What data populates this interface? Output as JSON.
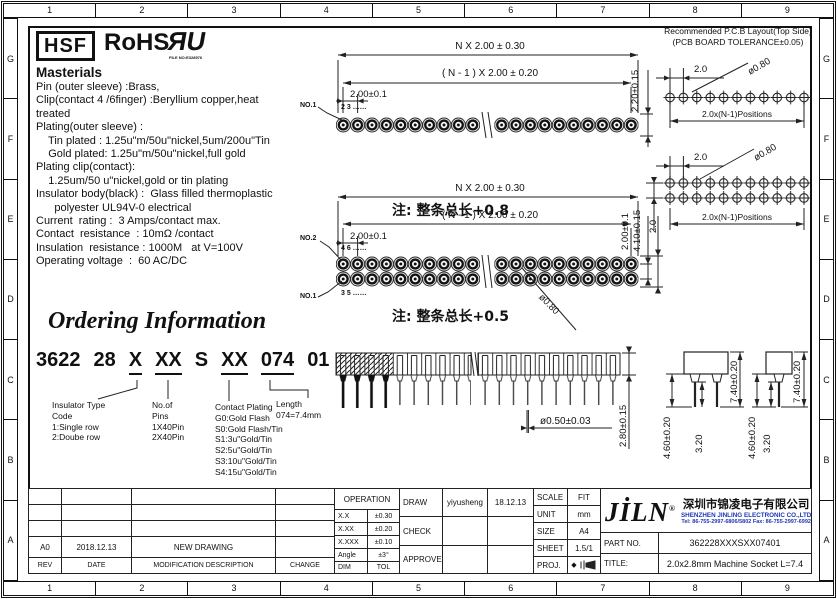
{
  "border": {
    "cols": [
      "1",
      "2",
      "3",
      "4",
      "5",
      "6",
      "7",
      "8",
      "9"
    ],
    "rows": [
      "G",
      "F",
      "E",
      "D",
      "C",
      "B",
      "A"
    ]
  },
  "header": {
    "hsf": "HSF",
    "rohs": "RoHS",
    "ul_mark": "ЯU",
    "ul_file": "FILE NO:E328976"
  },
  "materials": {
    "heading": "Masterials",
    "lines": [
      "Pin (outer sleeve) :Brass,",
      "Clip(contact 4 /6finger) :Beryllium copper,heat",
      "treated",
      "Plating(outer sleeve) :",
      "    Tin plated : 1.25u\"m/50u\"nickel,5um/200u\"Tin",
      "    Gold plated: 1.25u\"m/50u\"nickel,full gold",
      "Plating clip(contact):",
      "    1.25um/50 u\"nickel,gold or tin plating",
      "Insulator body(black) :  Glass filled thermoplastic",
      "      polyester UL94V-0 electrical",
      "Current  rating :  3 Amps/contact max.",
      "Contact  resistance  : 10mΩ /contact",
      "Insulation  resistance : 1000M   at V=100V",
      "Operating voltage  :  60 AC/DC"
    ]
  },
  "ordering": {
    "title": "Ordering Information",
    "code": [
      "3622",
      "28",
      "X",
      "XX",
      "S",
      "XX",
      "074",
      "01"
    ],
    "c1": [
      "Insulator  Type",
      "Code",
      "1:Single  row",
      "2:Doube  row"
    ],
    "c2": [
      "No.of",
      "Pins",
      "1X40Pin",
      "2X40Pin"
    ],
    "c3": [
      "Contact  Plating",
      "G0:Gold  Flash",
      "S0:Gold  Flash/Tin",
      "S1:3u\"Gold/Tin",
      "S2:5u\"Gold/Tin",
      "S3:10u\"Gold/Tin",
      "S4:15u\"Gold/Tin"
    ],
    "c4": [
      "Length",
      "074=7.4mm"
    ]
  },
  "drawing1": {
    "dim_total": "N X 2.00 ± 0.30",
    "dim_n1": "( N - 1 ) X 2.00 ± 0.20",
    "dim_pitch": "2.00±0.1",
    "dim_height": "2.20±0.15",
    "pin1": "NO.1",
    "pin_numbers": "2  3 ……",
    "note": "注: 整条总长+0.8"
  },
  "drawing2": {
    "dim_total": "N X 2.00 ± 0.30",
    "dim_n1": "( N - 1 ) X 2.00 ± 0.20",
    "dim_pitch": "2.00±0.1",
    "dim_row_pitch": "2.00±0.1",
    "dim_height": "4.10±0.15",
    "hole_dia": "ø0.80",
    "pin2": "NO.2",
    "pin2_numbers": "4  6 ……",
    "pin1": "NO.1",
    "pin1_numbers": "3  5 ……",
    "note": "注: 整条总长+0.5"
  },
  "pcb": {
    "line1": "Recommended P.C.B Layout(Top Side)",
    "line2": "(PCB BOARD TOLERANCE±0.05)",
    "pitch": "2.0",
    "hole": "ø0.80",
    "positions": "2.0x(N-1)Positions",
    "row_pitch": "2.0"
  },
  "side_view": {
    "pin_dia": "ø0.50±0.03",
    "height": "2.80±0.15"
  },
  "end_view": {
    "total": "7.40±0.20",
    "pin_len": "4.60±0.20",
    "mid": "3.20"
  },
  "titleblock": {
    "revision": {
      "row": [
        "A0",
        "2018.12.13",
        "NEW  DRAWING",
        ""
      ],
      "header": [
        "REV",
        "DATE",
        "MODIFICATION  DESCRIPTION",
        "CHANGE"
      ]
    },
    "tolerance": {
      "header": "OPERATION",
      "rows": [
        [
          "X.X",
          "±0.30"
        ],
        [
          "X.XX",
          "±0.20"
        ],
        [
          "X.XXX",
          "±0.10"
        ],
        [
          "Angle",
          "±3°"
        ],
        [
          "DIM",
          "TOL"
        ]
      ]
    },
    "signoff": {
      "draw": "DRAW",
      "draw_name": "yiyusheng",
      "draw_date": "18.12.13",
      "check": "CHECK",
      "approve": "APPROVE"
    },
    "info": {
      "scale": "SCALE",
      "scale_v": "FIT",
      "unit": "UNIT",
      "unit_v": "mm",
      "size": "SIZE",
      "size_v": "A4",
      "sheet": "SHEET",
      "sheet_v": "1.5/1",
      "proj": "PROJ.",
      "proj_sym": "◆"
    },
    "company": {
      "logo": "JİLN",
      "reg": "®",
      "cn": "深圳市锦凌电子有限公司",
      "en": "SHENZHEN JINLING ELECTRONIC CO.,LTD",
      "tel": "Tel: 86-755-2997-6806/5802   Fax: 86-755-2997-6992",
      "part_label": "PART NO.",
      "part_no": "362228XXXSXX07401",
      "title_label": "TITLE:",
      "title": "2.0x2.8mm  Machine  Socket  L=7.4"
    }
  }
}
